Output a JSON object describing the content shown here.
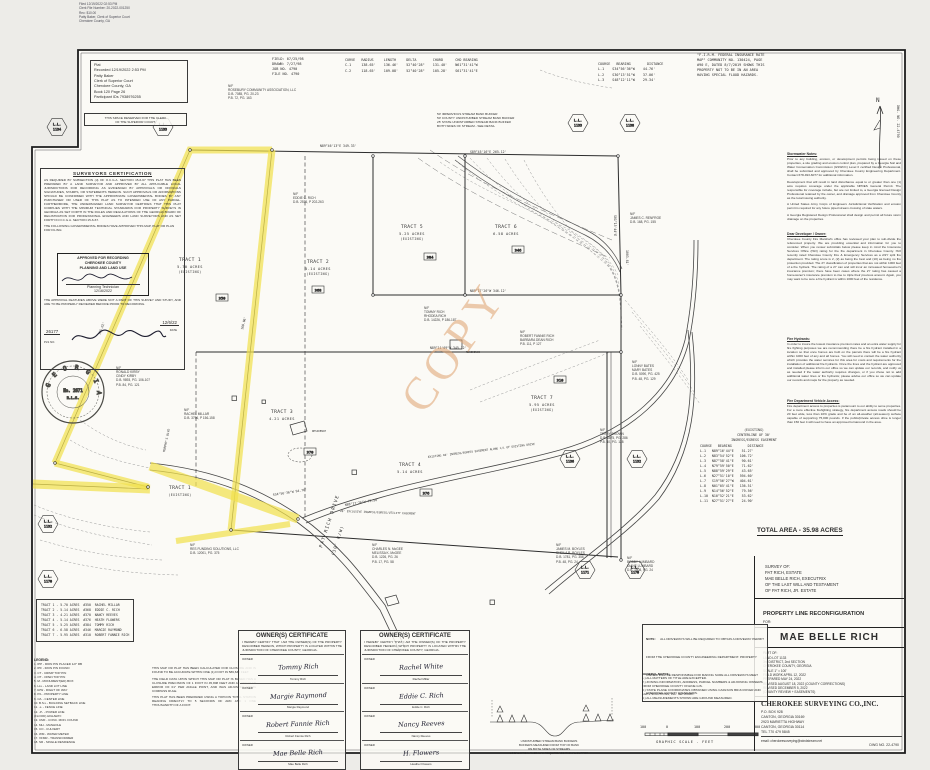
{
  "filing_stamp": {
    "lines": [
      "Filed 12/19/2022 02:53 PM",
      "Clerk File Number: 20-2022-001250",
      "Rec: $10.00",
      "Patty Baker, Clerk of Superior Court",
      "Cherokee County, GA"
    ]
  },
  "recording_box": {
    "lines": [
      "Plat",
      "Recorded 12/19/2022  2:53 PM",
      "Patty Baker",
      "Clerk of Superior Court",
      "Cherokee County, GA",
      "Book 120 Page 26",
      "Participant IDs 7938976255"
    ]
  },
  "reserved_box": {
    "lines": [
      "THIS SPACE RESERVED FOR THE CLERK",
      "OF THE SUPERIOR COURT."
    ]
  },
  "field_info": {
    "lines": [
      "FIELD: 07/25/98",
      "DRAWN: 7/27/98",
      "JOB NO. 4790",
      "FILE NO. 4790"
    ]
  },
  "curve_table": {
    "header": "CURVE   RADIUS     LENGTH     DELTA        CHORD      CHD BEARING",
    "rows": [
      "C-1     138.65'    136.46'    52°40'28\"    131.40'    N61°31'41\"W",
      "C-2     118.65'    109.08'    52°40'28\"    105.28'    S61°31'41\"E"
    ]
  },
  "course_table": {
    "header": "COURSE   BEARING        DISTANCE",
    "rows": [
      "L-1    S34°56'36\"W    44.76'",
      "L-2    S30°13'51\"W    37.06'",
      "L-3    S48°12'11\"W    29.34'"
    ]
  },
  "firm_note": {
    "lines": [
      "\"F.I.R.M. FEDERAL INSURANCE RATE",
      "MAP\" COMMUNITY NO. 130424, PAGE",
      "#90 E, DATED 8/7/2019 SHOWS THIS",
      "PROPERTY NOT TO BE IN AN AREA",
      "HAVING SPECIAL FLOOD HAZARDS."
    ]
  },
  "compass": {
    "n": "N",
    "side_label": "DWG. NO. 22-4790"
  },
  "notes": {
    "stormwater": {
      "title": "Stormwater Notes:",
      "paras": [
        "Prior to any building, erosion, or development permits being issued on these properties, a site grading and erosion control plan, prepared by a Georgia Soil and Water Conservation Commission (GSWCC) Level II certified Design Professional, shall be submitted and approved by Cherokee County Engineering Department. Contact 678-493-6077 for additional information.",
        "Development that will result in land disturbance equal to or greater than one (1) acre requires coverage under the applicable NPDES General Permit. The responsible for coverage include, but are not limited to, a Georgia licensed Design Professional retained by the owner, and drainage approved from Cherokee County as the local issuing authority.",
        "A United States Army Corps of Engineers Jurisdictional Verification and erosion permit is required for any future piped stream crossing of state waters.",
        "A Georgia Registered Design Professional shall design and permit all future storm drainage on the properties."
      ]
    },
    "developer": {
      "title": "Dear Developer / Owner:",
      "paras": [
        "Cherokee County Fire Marshal's office has reviewed your plan to sub-divide the referenced property. We are providing essential and information for you to consider. When you review submittals below please keep in mind the Insurance Services Office (ISO) rating for the fire department in Cherokee County. ISO recently rated Cherokee County Fire & Emergency Services as a 2/2Y split fire department. The rating score is 2, (2) as being the best and (10) as being no fire protection provided. The 2Y classification of properties that are not within 1000 feet of a fire hydrant. The rating of a 2Y can and will incur an increased homeowner's insurance premium; there have been cases where the 2Y rating has caused a homeowner's insurance premium to rise to triple their previous amount. Again, you may want to be sure a fire hydrant is within 1000 feet of the residence."
      ]
    },
    "hydrant": {
      "title": "Fire Hydrants:",
      "paras": [
        "In order to insure the lowest insurance premium rates and an extra water supply for fire fighting purposes we are recommending there be a fire hydrant installed in a location so that once homes are built on the parcels there will be a fire hydrant within 1000 feet of any and all homes. You will need to contact the water authority which provides the water services for this area for costs and requirements for the installation of additional fire hydrants. Once the lines and the hydrant are approved and installed please inform our office so we can update our records, and notify us as needed if the water authority requires changes, or if you chose not to add additional water lines or fire hydrants; please advise our office so we can update our records and maps for the property as needed."
      ]
    },
    "access": {
      "title": "Fire Department Vehicle Access:",
      "paras": [
        "Fire department access to properties is paramount to our ability to serve properties. For a more effective firefighting strategy, fire department access roads should be 20 feet wide, less than 10% grade and be of an all-weather (all-season) surface capable of supporting 75,000 pounds. If the public/private access drive is longer than 150 feet it will need to have an approved turnaround in the area."
      ]
    }
  },
  "easement_table": {
    "title_lines": [
      "(EXISTING)",
      "CENTERLINE OF 30'",
      "INGRESS/EGRESS EASEMENT"
    ],
    "header": "COURSE   BEARING        DISTANCE",
    "rows": [
      "L-1   N89°16'44\"E    51.27'",
      "L-2   N83°54'52\"E   106.72'",
      "L-3   N87°58'41\"E    90.61'",
      "L-4   N79°59'50\"E    71.62'",
      "L-5   N88°59'29\"E    43.65'",
      "L-6   N27°51'10\"E   594.60'",
      "L-7   S19°56'27\"W   404.61'",
      "L-8   N01°05'41\"E   136.51'",
      "L-9   N14°56'52\"E    79.56'",
      "L-10  N10°52'21\"E    53.62'",
      "L-11  N27°51'27\"E    24.90'"
    ]
  },
  "total_area": "TOTAL AREA  -  35.98 ACRES",
  "title_block": {
    "survey_of": [
      "SURVEY OF:",
      "PAT RICH, ESTATE",
      "MAE BELLE RICH, EXECUTRIX",
      "OF THE LAST WILL AND TESTAMENT",
      "OF PAT RICH, JR. ESTATE"
    ],
    "reconfig": "PROPERTY LINE RECONFIGURATION",
    "for_label": "FOR:",
    "client": "MAE BELLE RICH",
    "part_of": [
      "PART OF:",
      "LAND LOT 1133",
      "3rd DISTRICT, 2nd SECTION",
      "CHEROKEE COUNTY, GEORGIA",
      "SCALE 1\" = 100'",
      "FIELD WORK APRIL 12, 2022",
      "PREPARED MAY 24, 2022",
      "REVISED AUGUST 18, 2022 (COUNTY CORRECTIONS)",
      "REVISED DECEMBER 5, 2022",
      "(COUNTY REVIEW + EASEMENTS)"
    ],
    "firm": "CHEROKEE SURVEYING CO.,INC.",
    "firm_addr": [
      "P.O. BOX 928",
      "CANTON, GEORGIA 30169",
      "2923 MARIETTA HIGHWAY",
      "CANTON, GEORGIA 30114",
      "TEL 770 479 5845"
    ],
    "email": "email: cherokeesurveying@windstream.net",
    "dwg_no": "DWG NO. 22-4790"
  },
  "certification": {
    "title": "SURVEYORS CERTIFICATION",
    "body": "AS REQUIRED BY SUBSECTION (d) OF O.C.G.A. SECTION 15-6-67 THIS PLAT HAS BEEN PREPARED BY A LAND SURVEYOR AND APPROVED BY ALL APPLICABLE LOCAL JURISDICTIONS FOR RECORDING AS EVIDENCED BY APPROVALS OR OFFICIALS SIGNATURES, STAMPS, OR STATEMENTS HEREON. SUCH APPROVALS OR AFFIRMATIONS SHOULD BE CONFIRMED WITH THE APPROPRIATE GOVERNMENTAL BODIES BY ANY PURCHASER OR USER OF THIS PLAT AS TO INTENDED USE OF ANY PARCEL. FURTHERMORE, THE UNDERSIGNED LAND SURVEYOR CERTIFIES THAT THIS PLAT COMPLIES WITH THE MINIMUM TECHNICAL STANDARDS FOR PROPERTY SURVEYS IN GEORGIA AS SET FORTH IN THE RULES AND REGULATIONS OF THE GEORGIA BOARD OF REGISTRATION FOR PROFESSIONAL ENGINEERS AND LAND SURVEYORS AND AS SET FORTH IN O.C.G.A. SECTION 15-6-67.",
    "filing_line": "THE FOLLOWING GOVERNMENTAL BODIES HAVE APPROVED THIS MAP, PLAT OR PLAN FOR FILING:",
    "stamp_lines": [
      "APPROVED FOR RECORDING",
      "CHEROKEE COUNTY",
      "PLANNING AND LAND USE"
    ],
    "stamp_role": "Planning Technician",
    "stamp_date": "12/16/2022",
    "post_note": "THE APPROVAL FEATURES ABOVE WERE NOT A PART OF THIS SURVEY AND STUDY, AND ARE TO BE PROPERLY REVIEWED BEFORE PRIOR TO RECORDING.",
    "pls_no": "26177",
    "sign_date": "12/6/22",
    "pls_label": "PLS NO.",
    "date_label": "DATE"
  },
  "seal": {
    "ring": "G E O R G I A",
    "center": "No. 2671",
    "sub": "R.L.S."
  },
  "tract_table": {
    "rows": [
      "TRACT 1 - 5.70 ACRES  #350  RACHEL MILLAR",
      "TRACT 2 - 5.14 ACRES  #368  EDDIE C. RICH",
      "TRACT 3 - 4.21 ACRES  #370  NANCY REEVES",
      "TRACT 4 - 5.14 ACRES  #376  HEATH FLOWERS",
      "TRACT 5 - 5.25 ACRES  #384  TOMMY RICH",
      "TRACT 6 - 6.58 ACRES  #346  MARGIE RAYMOND",
      "TRACT 7 - 5.95 ACRES  #310  ROBERT FANNIE RICH"
    ]
  },
  "legend": {
    "title": "LEGEND:",
    "items": [
      "1. IPP - IRON PIN PLACED 1/2\" RB",
      "2. IPF - IRON PIN FOUND",
      "3. CT - CRIMP TOP PIN",
      "4. OT - OPEN TOP PIN",
      "5. M - MONUMENT(ED) BOX",
      "6. LLL - LAND LOT LINE",
      "7. R/W - RIGHT OF WAY",
      "8. P/L - PROPERTY LINE",
      "9. C/L - CENTER LINE",
      "10. B.S.L - BUILDING SETBACK LINE",
      "11. -x- - FENCE LINE",
      "12. -P- - POWER LINE",
      "(FLOOD) HIGHWAY:",
      "13. CMF - CONC. MON. FOUND",
      "14. MH - MANHOLE",
      "15. CO - CULVERT",
      "16. WM - WATER METER",
      "17. XFMR - TRANSFORMER",
      "18. SR - SINGLE RESIDENCE"
    ]
  },
  "closure": {
    "paras": [
      "THIS MAP OR PLAT HAS BEEN CALCULATED FOR CLOSURE AND IS FOUND TO BE ACCURATE WITHIN ONE (1) FOOT IN  586,636  FEET.",
      "THE FIELD DATA UPON WHICH THIS MAP OR PLAT IS BASED HAS A CLOSURE PRECISION OF 1 FOOT IN  45,808  FEET AND AN ANGULAR ERROR OF  01\"  PER ANGLE POINT, AND WAS ADJUSTED USING  COMPASS  RULE.",
      "THIS PLAT HAS BEEN PREPARED USING A TOPCON TOTAL STATION READING DIRECTLY TO 5 SECONDS OF ARC AND 1 ONE THOUSANDTH OF A FOOT."
    ]
  },
  "owner_cert": {
    "title": "OWNER(S) CERTIFICATE",
    "body": "I HEREBY CERTIFY THAT I AM THE OWNER(S) OF THE PROPERTY DESCRIBED HEREON, WHICH PROPERTY IS LOCATED WITHIN THE JURISDICTION OF CHEROKEE COUNTY, GEORGIA.",
    "label": "OWNER",
    "left": [
      {
        "sig": "Tommy Rich",
        "name": "Tommy Rich"
      },
      {
        "sig": "Margie Raymond",
        "name": "Margie Raymond"
      },
      {
        "sig": "Robert Fannie Rich",
        "name": "Robert Fannie Rich"
      },
      {
        "sig": "Mae Belle Rich",
        "name": "Mae Belle Rich"
      }
    ],
    "right": [
      {
        "sig": "Rachel White",
        "name": "Rachel Millar"
      },
      {
        "sig": "Eddie C. Rich",
        "name": "Eddie C. Rich"
      },
      {
        "sig": "Nancy Reeves",
        "name": "Nancy Reeves"
      },
      {
        "sig": "H. Flowers",
        "name": "Heather Flowers"
      }
    ]
  },
  "note_box": {
    "title": "NOTE:",
    "body": "ALL DRIVEWAYS WILL BE REQUIRED TO OBTAIN A DRIVEWAY PERMIT FROM THE CHEROKEE COUNTY ENGINEERING DEPARTMENT. PROPERTY OWNER WILL BE RESPONSIBLE FOR MAKING SURE ALL DRIVEWAYS MEET CHEROKEE COUNTY STANDARDS."
  },
  "general_notes": {
    "title": "GENERAL NOTES:",
    "items": [
      "1.)  ALL MATTERS OF TITLE ARE EXCEPTED.",
      "2.)  ZONING INFORMATION, ADDRESS, PARCEL NUMBERS & ADJOINING OWNERS FROM CHEROKEE COUNTY ONLINE GIS.",
      "3.)  STATE PLANE COORDINATES OBTAINED USING CARLSON BRx6 ROVER AND eGPS SOLUTIONS, INC. NETWORK.",
      "4.)  ALL MEASUREMENTS SHOWN ARE GROUND MEASURED."
    ]
  },
  "scale_bar": {
    "labels": [
      "100",
      "0",
      "100",
      "200",
      "300"
    ],
    "caption": "GRAPHIC SCALE  -  FEET"
  },
  "buffer_detail": {
    "lines": [
      "UNDISTURBED STREAM BANK BUFFERS",
      "BUFFERS MEASURED FROM TOP OF BANK",
      "ON BOTH SIDES OF STREAMS",
      "LOCAL ORDINANCE MAY REQUIRE ADDITIONAL BUFFER"
    ]
  },
  "buffer_note": {
    "lines": [
      "50' IMPERVIOUS STREAM BANK BUFFER",
      "50' COUNTY UNDISTURBED STREAM BANK BUFFER",
      "25' STATE UNDISTURBED STREAM BANK BUFFER",
      "BOTH SIDES OF STREAM - SEE DETAIL"
    ]
  },
  "watermark": "COPY",
  "map": {
    "ll_label": "L.L.",
    "tracts": [
      {
        "name": "TRACT 1",
        "acres": "5.70 ACRES",
        "status": "(EXISTING)"
      },
      {
        "name": "TRACT 2",
        "acres": "5.14 ACRES",
        "status": "(EXISTING)"
      },
      {
        "name": "TRACT 5",
        "acres": "5.25 ACRES",
        "status": "(EXISTING)"
      },
      {
        "name": "TRACT 6",
        "acres": "6.58 ACRES",
        "status": ""
      },
      {
        "name": "TRACT 3",
        "acres": "4.21 ACRES",
        "status": ""
      },
      {
        "name": "TRACT 4",
        "acres": "5.14 ACRES",
        "status": ""
      },
      {
        "name": "TRACT 7",
        "acres": "5.95 ACRES",
        "status": "(EXISTING)"
      },
      {
        "name": "TRACT 1",
        "acres": "",
        "status": "(EXISTING)"
      }
    ],
    "adjoiners": [
      {
        "lines": [
          "N/F",
          "ROSEBURY COMMUNITY ASSOCIATION, LLC",
          "D.B. 7085, PG. 20-23",
          "P.B. 72, PG. 163"
        ]
      },
      {
        "lines": [
          "N/F",
          "EDDIE C. RICH",
          "D.B. 2576, P 202-263"
        ]
      },
      {
        "lines": [
          "N/F",
          "JAMES C. RENFROE",
          "D.B. 168, PG. 155"
        ]
      },
      {
        "lines": [
          "N/F",
          "TOMMY RICH",
          "RHODEA RICH",
          "D.B. 14226, P 186-187"
        ]
      },
      {
        "lines": [
          "N/F",
          "ROBERT FANNIE RICH",
          "BARBARA DEAN RICH",
          "P.B. 111, P 127"
        ]
      },
      {
        "lines": [
          "N/F",
          "LONNY BATES",
          "MARY BATES",
          "D.B. 5090, PG. 425",
          "P.B. 48, PG. 129"
        ]
      },
      {
        "lines": [
          "N/F",
          "RONALD KIRBY",
          "CINDY KIRBY",
          "D.B. 9893, PG. 106-107",
          "P.B. 84, PG. 121"
        ]
      },
      {
        "lines": [
          "N/F",
          "RACHEL MILLAR",
          "D.B. 3796, P 156-158"
        ]
      },
      {
        "lines": [
          "N/F",
          "TERRY BROWN",
          "D.B. 6875, PG. 286",
          "P.B. 40, PG. 128"
        ]
      },
      {
        "lines": [
          "N/F",
          "RES FUNDING SOLUTIONS, LLC",
          "D.B. 12001, PG. 375"
        ]
      },
      {
        "lines": [
          "N/F",
          "CHARLES N. McGEE",
          "MELISSA K. McGEE",
          "D.B. 1226, PG. 26",
          "P.B. 17, PG. 58"
        ]
      },
      {
        "lines": [
          "N/F",
          "JAMES M. BOYLES",
          "SHEILA R. BOYLES",
          "D.B. 1781, PG. 356",
          "P.B. 48, PG. 24"
        ]
      },
      {
        "lines": [
          "N/F",
          "BOBBY LUMBARD",
          "DIANE LUMBARD",
          "D.B. 1508, PG. 24"
        ]
      }
    ],
    "hex_nums": [
      "1134",
      "1133",
      "1133",
      "1138",
      "1132",
      "1170",
      "1136",
      "1132",
      "1171",
      "1170"
    ],
    "addresses": [
      "350",
      "368",
      "370",
      "376",
      "384",
      "346",
      "310"
    ],
    "bearings": [
      "N89°46'13\"E  349.33'",
      "S89°45'16\"E  265.12'",
      "1003.81'",
      "N89°17'26\"W  346.12'",
      "N89°11'09\"W  345.12'",
      "S34°56'36\"W  94.76'",
      "N88°17'26\"W  75.58'",
      "160.06'",
      "165.02'",
      "S01°15'44\"E"
    ],
    "road": [
      "PAT RICH DRIVE",
      "(30' R/W)"
    ],
    "road2": "MURPHY'S BLVD",
    "residence": "RESIDENCE",
    "easement_labels": [
      "EXISTING 40' INGRESS/EGRESS EASEMENT ALONG C/L OF EXISTING DRIVE",
      "20' EXCLUSIVE INGRESS/EGRESS/UTILITY EASEMENT"
    ]
  },
  "colors": {
    "highlight": "#f1e14e",
    "watermark": "#dfa26f",
    "ink": "#2e2e2e",
    "stamp": "#4a4a55"
  }
}
